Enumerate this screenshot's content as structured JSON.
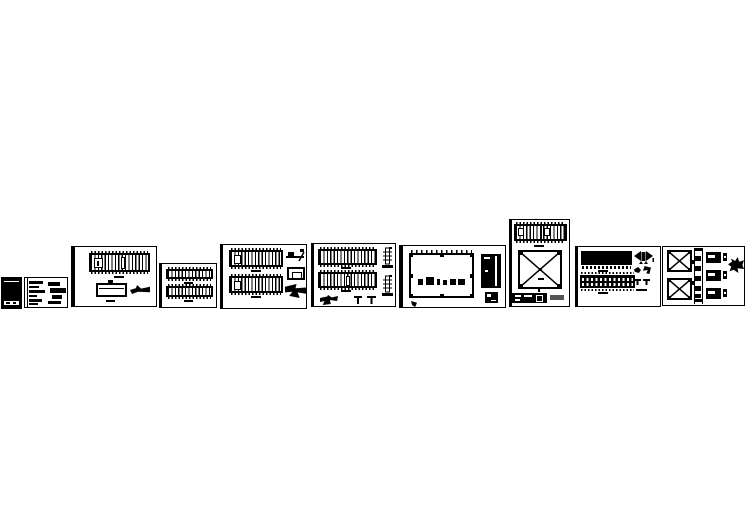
{
  "canvas": {
    "background_color": "#ffffff",
    "ink_color": "#000000",
    "muted_ink_color": "#555555",
    "description": "Preview strip of ten structural CAD drawing sheets arranged in a horizontal row on a blank white background"
  },
  "sheets": [
    {
      "id": "sheet-01",
      "name": "cover-sheet",
      "content": "solid dark cover page with a thin white rule near the top and a white footer band with small marks"
    },
    {
      "id": "sheet-02",
      "name": "general-notes-sheet",
      "content": "left margin line with two columns of dense illegible note text blocks"
    },
    {
      "id": "sheet-03",
      "name": "truss-elevation-sheet",
      "content": "vertically hatched truss elevation band, foundation box detail with stub, and a leader-note blob"
    },
    {
      "id": "sheet-04",
      "name": "double-truss-elevation-sheet",
      "content": "two stacked vertically hatched truss elevation bands with small title dashes"
    },
    {
      "id": "sheet-05",
      "name": "truss-elevations-with-details-sheet",
      "content": "two hatched truss elevation bands plus joint detail, plate box detail and gusset blob detail on the right"
    },
    {
      "id": "sheet-06",
      "name": "truss-elevations-with-column-details-sheet",
      "content": "two hatched truss elevation bands, two column section details on the right, anchor tee details and gusset blob along the bottom"
    },
    {
      "id": "sheet-07",
      "name": "framing-plan-sheet",
      "content": "rectangular framing plan with grid tick marks, node squares at corners and mid-edges, a row of symbol blobs inside, a dark door-panel detail and a small dark box detail at right"
    },
    {
      "id": "sheet-08",
      "name": "bracing-elevation-sheet",
      "content": "tall sheet with a two-panel hatched truss band on top, large X cross-bracing square diagram, dark schedule bar with white dashes and a grey note blob at bottom"
    },
    {
      "id": "sheet-09",
      "name": "panel-elevation-sheet",
      "content": "solid black deck band with toothed edge, perforated panel band with two rows of white openings, and hardware glyphs (bowtie, hooks, tee anchors) at right"
    },
    {
      "id": "sheet-10",
      "name": "bracing-and-girt-details-sheet",
      "content": "two X-brace squares at left, segmented vertical column with cleats in the middle, three member schedule bars with white slots, and a clamp glyph at right"
    }
  ]
}
